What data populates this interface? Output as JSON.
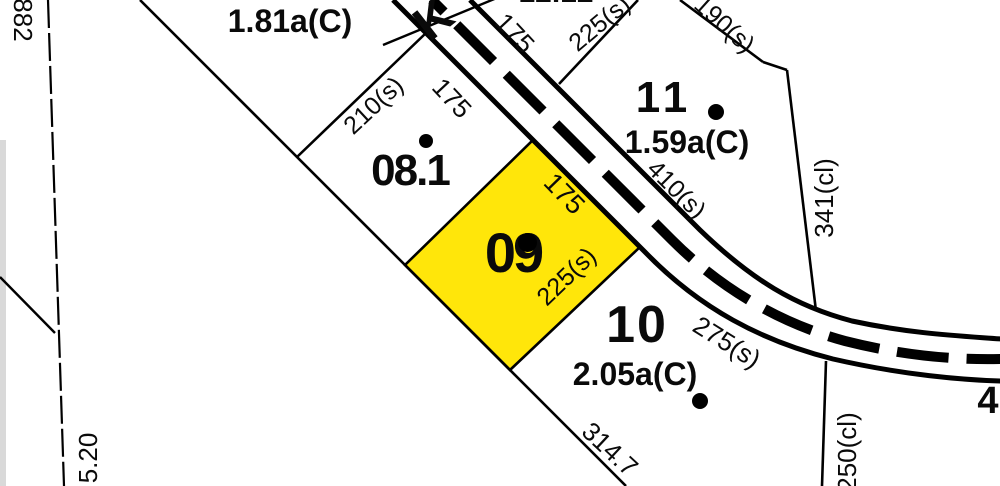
{
  "parcels": {
    "p181": {
      "area_label": "1.81a(C)"
    },
    "p1212": {
      "number": "12.12"
    },
    "p081": {
      "number": "08.1"
    },
    "p09": {
      "number": "09"
    },
    "p10": {
      "number": "10",
      "area_label": "2.05a(C)"
    },
    "p11": {
      "number": "11",
      "area_label": "1.59a(C)"
    },
    "p4": {
      "number": "4"
    }
  },
  "dimensions": {
    "top_175": "175",
    "top_225s": "225(s)",
    "d190s": "190(s)",
    "d410s": "410(s)",
    "d341cl": "341(cl)",
    "d210s": "210(s)",
    "mid_175": "175",
    "p09_175": "175",
    "p09_225s": "225(s)",
    "d275s": "275(s)",
    "d314_7": "314.7",
    "d250cl": "250(cl)",
    "left_882": "882",
    "left_5_20": "5.20"
  },
  "road": {
    "partial_name": "K"
  },
  "colors": {
    "highlight_parcel": "#ffe60a",
    "line": "#000000",
    "background": "#ffffff"
  }
}
